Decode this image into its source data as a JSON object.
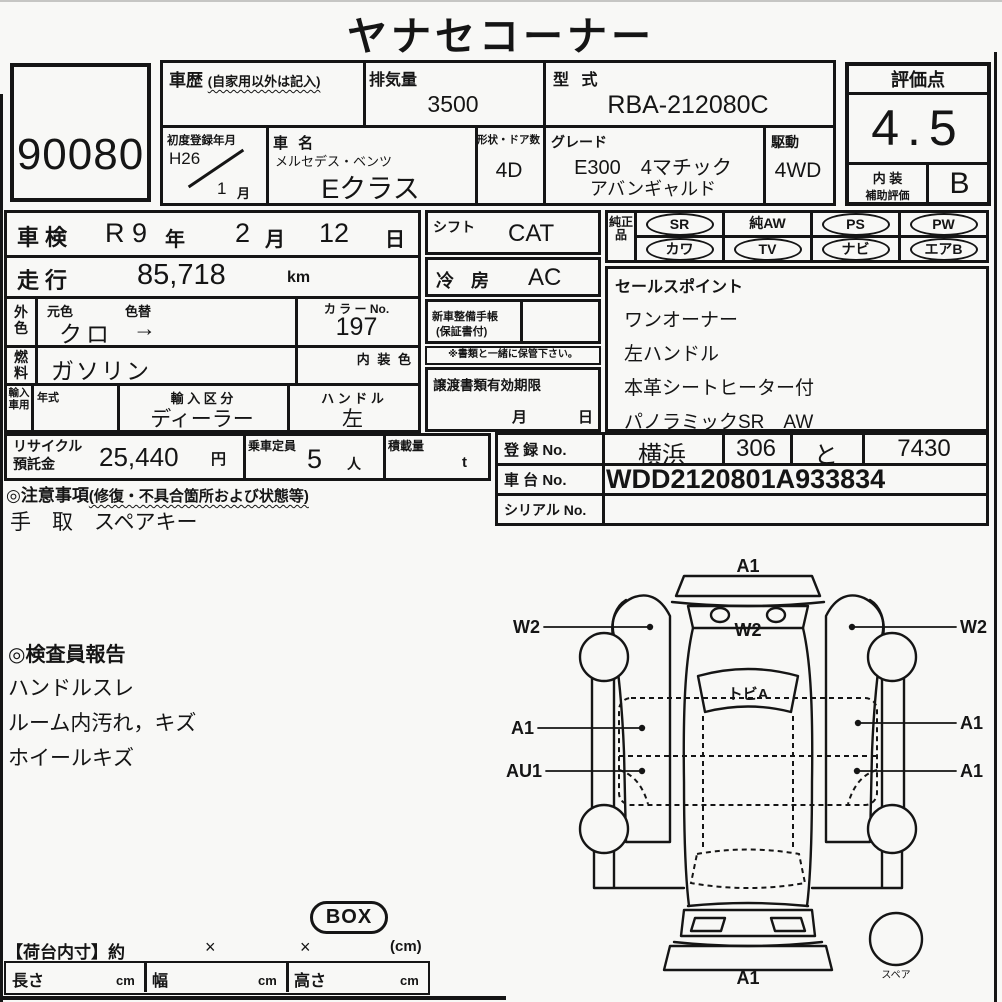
{
  "colors": {
    "ink": "#151515",
    "paper": "#f8f8f6"
  },
  "title": "ヤナセコーナー",
  "lot_number": "90080",
  "vehicle": {
    "history_label": "車歴",
    "history_note": "(自家用以外は記入)",
    "displacement_label": "排気量",
    "displacement_value": "3500",
    "model_code_label": "型 式",
    "model_code_value": "RBA-212080C",
    "first_reg_label": "初度登録年月",
    "first_reg_year": "H26",
    "first_reg_month": "1",
    "first_reg_month_unit": "月",
    "name_label": "車 名",
    "maker_name": "メルセデス・ベンツ",
    "model_name": "Eクラス",
    "body_doors_label": "形状・ドア数",
    "body_doors_value": "4D",
    "grade_label": "グレード",
    "grade_line1": "E300　4マチック",
    "grade_line2": "アバンギャルド",
    "drive_label": "駆動",
    "drive_value": "4WD"
  },
  "rating": {
    "score_label": "評価点",
    "score": "4.5",
    "interior_label_line1": "内 装",
    "interior_label_line2": "補助評価",
    "interior_grade": "B"
  },
  "left_table": {
    "shaken_label": "車検",
    "shaken_era": "R 9",
    "shaken_year_unit": "年",
    "shaken_month": "2",
    "shaken_month_unit": "月",
    "shaken_day": "12",
    "shaken_day_unit": "日",
    "mileage_label": "走行",
    "mileage_value": "85,718",
    "mileage_unit": "km",
    "exterior_label": "外色",
    "orig_color_label": "元色",
    "color_change_label": "色替",
    "orig_color_value": "クロ",
    "color_change_value": "→",
    "color_no_label": "カ ラ ー No.",
    "color_no_value": "197",
    "fuel_label": "燃料",
    "fuel_value": "ガソリン",
    "interior_color_label": "内 装 色",
    "import_label": "輸入車用",
    "import_year_label": "年式",
    "import_division_label": "輸 入 区 分",
    "import_division_value": "ディーラー",
    "handle_label": "ハ ン ド ル",
    "handle_value": "左"
  },
  "middle": {
    "shift_label": "シフト",
    "shift_value": "CAT",
    "aircon_label": "冷 房",
    "aircon_value": "AC",
    "maintenance_book_line1": "新車整備手帳",
    "maintenance_book_line2": "(保証書付)",
    "keep_note": "※書類と一緒に保管下さい。",
    "transfer_docs_label": "譲渡書類有効期限",
    "transfer_month_unit": "月",
    "transfer_day_unit": "日"
  },
  "genuine_parts": {
    "label": "純正品",
    "items": [
      {
        "label": "SR",
        "circled": true
      },
      {
        "label": "純AW",
        "circled": false
      },
      {
        "label": "PS",
        "circled": true
      },
      {
        "label": "PW",
        "circled": true
      },
      {
        "label": "カワ",
        "circled": true
      },
      {
        "label": "TV",
        "circled": true
      },
      {
        "label": "ナビ",
        "circled": true
      },
      {
        "label": "エアB",
        "circled": true
      }
    ]
  },
  "sales_points": {
    "header": "セールスポイント",
    "items": [
      "ワンオーナー",
      "左ハンドル",
      "本革シートヒーター付",
      "パノラミックSR　AW"
    ]
  },
  "recycle_row": {
    "recycle_label_line1": "リサイクル",
    "recycle_label_line2": "預託金",
    "recycle_value": "25,440",
    "recycle_unit": "円",
    "capacity_label": "乗車定員",
    "capacity_value": "5",
    "capacity_unit": "人",
    "load_label": "積載量",
    "load_unit": "t"
  },
  "cautions": {
    "header": "◎注意事項",
    "header_note": "(修復・不具合箇所および状態等)",
    "text": "手　取　スペアキー"
  },
  "registration": {
    "reg_no_label": "登 録 No.",
    "reg_area": "横浜",
    "reg_class": "306",
    "reg_kana": "と",
    "reg_number": "7430",
    "chassis_no_label": "車 台 No.",
    "chassis_no_value": "WDD2120801A933834",
    "serial_no_label": "シリアル No.",
    "serial_no_value": ""
  },
  "inspector_report": {
    "header": "◎検査員報告",
    "items": [
      "ハンドルスレ",
      "ルーム内汚れ，キズ",
      "ホイールキズ"
    ]
  },
  "diagram": {
    "front_bumper_label": "A1",
    "hood_label": "W2",
    "left_door_label": "W2",
    "right_door_label": "W2",
    "windshield_label": "トビA",
    "left_mid_label": "A1",
    "right_mid_label": "A1",
    "left_rocker_label": "AU1",
    "right_rocker_label": "A1",
    "rear_bumper_label": "A1",
    "spare_label": "スペア"
  },
  "cargo": {
    "box_badge": "BOX",
    "header": "【荷台内寸】約",
    "times1": "×",
    "times2": "×",
    "unit_note": "(cm)",
    "length_label": "長さ",
    "width_label": "幅",
    "height_label": "高さ",
    "cm_unit": "cm"
  }
}
